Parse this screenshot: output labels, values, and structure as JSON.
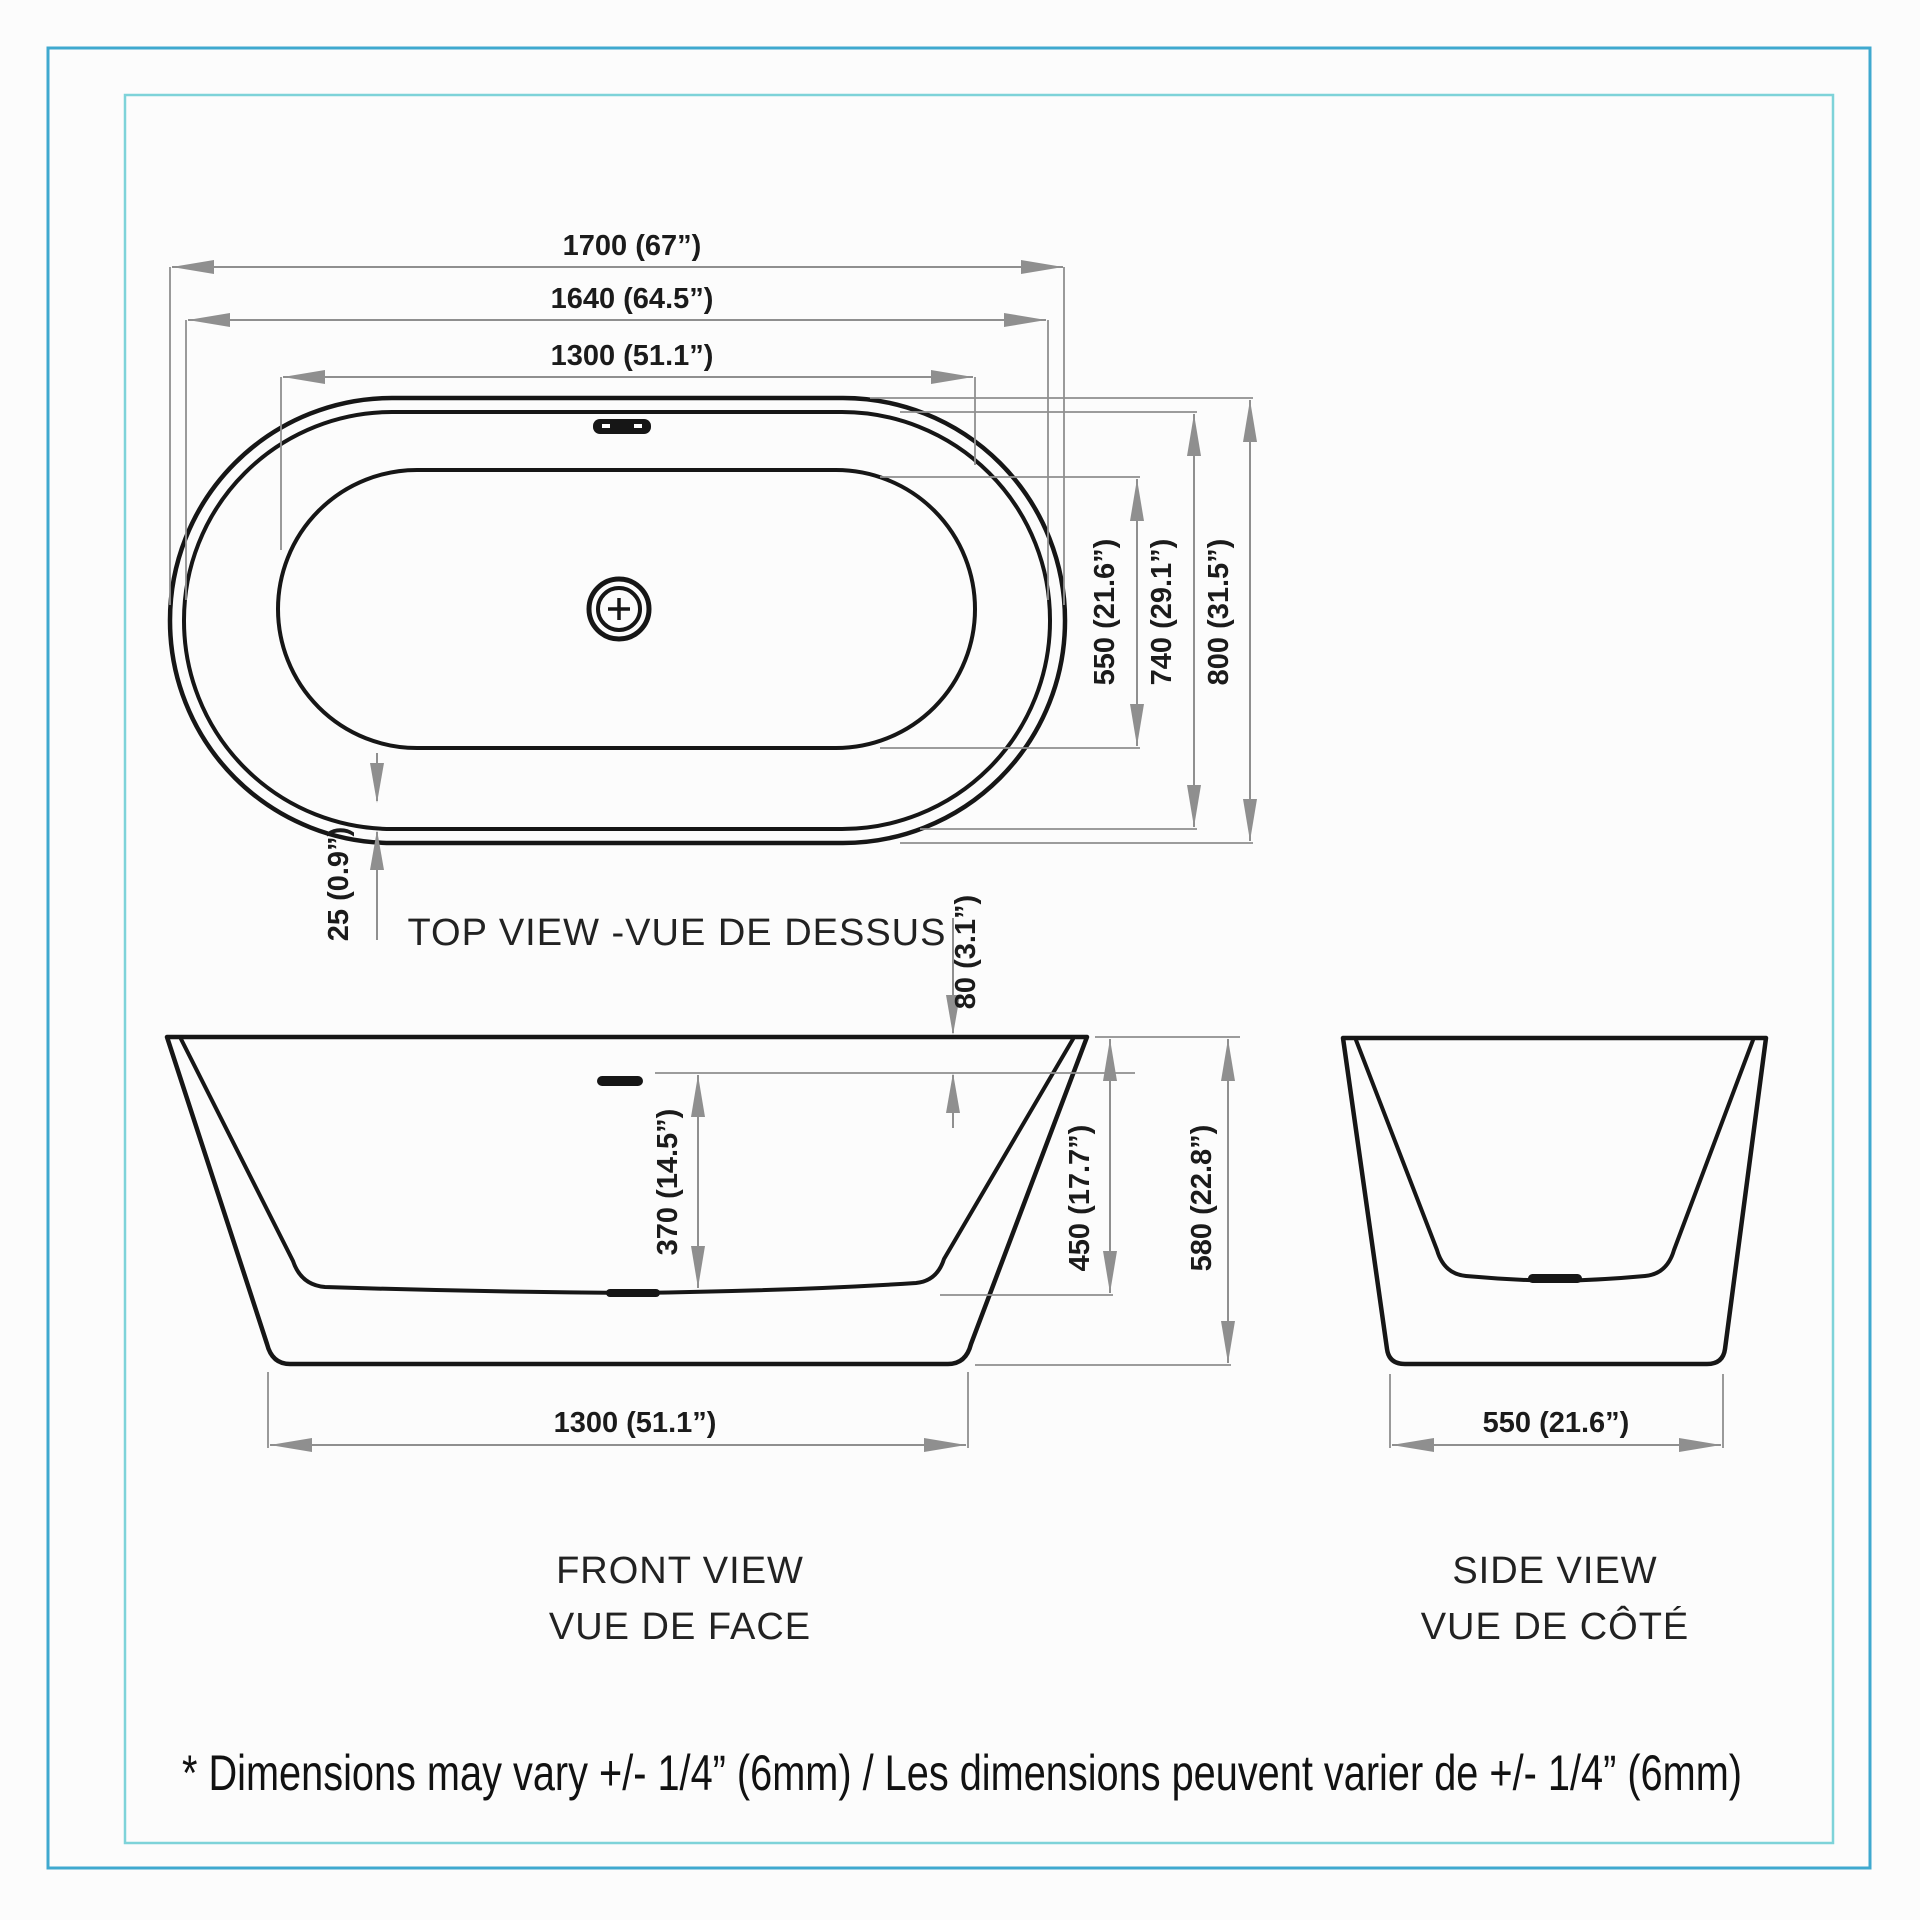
{
  "colors": {
    "outer_border": "#3fa9cf",
    "inner_border": "#7ed3d9",
    "tub_line": "#161616",
    "dim_line": "#8f8f8f",
    "text": "#1b1b1b",
    "background": "#fcfcfc"
  },
  "footnote": "* Dimensions may vary +/- 1/4” (6mm) / Les dimensions peuvent varier de +/- 1/4” (6mm)",
  "views": {
    "top": {
      "title": "TOP VIEW -VUE DE DESSUS",
      "dims": {
        "overall_length": "1700 (67”)",
        "rim_length": "1640 (64.5”)",
        "basin_length": "1300 (51.1”)",
        "basin_width": "550 (21.6”)",
        "rim_width": "740 (29.1”)",
        "overall_width": "800 (31.5”)",
        "rim_thickness": "25 (0.9”)"
      }
    },
    "front": {
      "title_en": "FRONT VIEW",
      "title_fr": "VUE DE FACE",
      "dims": {
        "overflow_drop": "80 (3.1”)",
        "overflow_to_bottom": "370 (14.5”)",
        "basin_depth": "450 (17.7”)",
        "overall_height": "580 (22.8”)",
        "base_length": "1300 (51.1”)"
      }
    },
    "side": {
      "title_en": "SIDE VIEW",
      "title_fr": "VUE DE CÔTÉ",
      "dims": {
        "base_width": "550 (21.6”)"
      }
    }
  }
}
